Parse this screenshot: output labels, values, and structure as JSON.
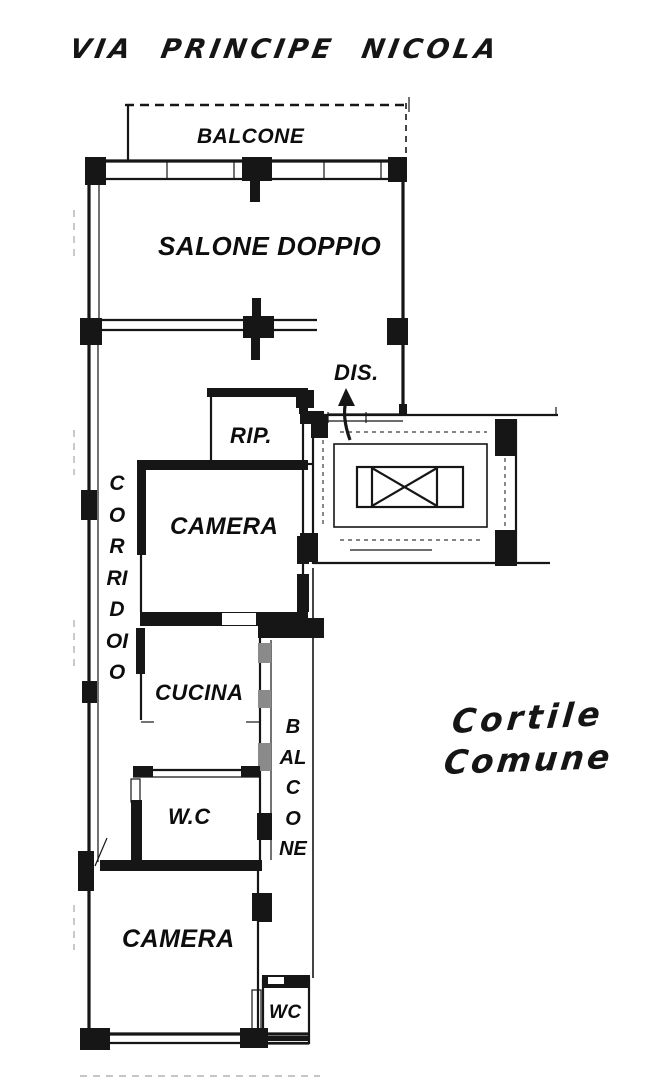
{
  "plan": {
    "street_label": "VIA PRINCIPE NICOLA",
    "courtyard": {
      "line1": "Cortile",
      "line2": "Comune"
    },
    "rooms": {
      "balcony_top": "BALCONE",
      "living_room": "SALONE DOPPIO",
      "hallway_vertical": "CORRIDOIO",
      "disimpegno": "DIS.",
      "storage": "RIP.",
      "bedroom_upper": "CAMERA",
      "kitchen": "CUCINA",
      "balcony_side_vertical": "BALCONE",
      "wc_main": "W.C",
      "bedroom_lower": "CAMERA",
      "wc_small": "WC"
    },
    "colors": {
      "ink": "#161616",
      "paper": "#ffffff"
    }
  }
}
